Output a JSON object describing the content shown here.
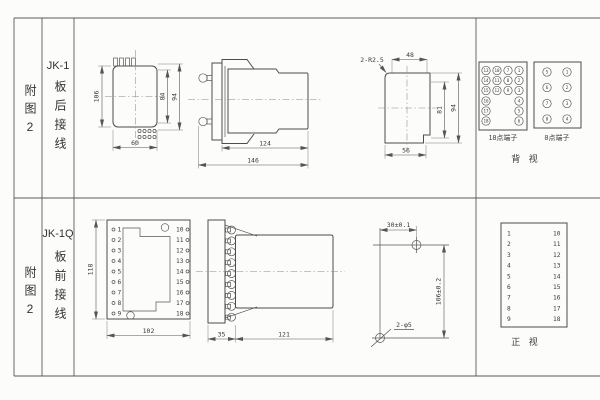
{
  "row1": {
    "figure_label": "附图2",
    "model": "JK-1",
    "wiring": "板后接线",
    "rear_view": {
      "dim_height": "106",
      "dim_inner": "84",
      "dim_outer": "94",
      "dim_width": "60"
    },
    "side_view": {
      "dim_body": "124",
      "dim_total": "146"
    },
    "cutout": {
      "callout": "2-R2.5",
      "dim_top": "48",
      "dim_inner": "81",
      "dim_outer": "94",
      "dim_bottom": "56"
    },
    "terminal18": {
      "label": "18点端子",
      "rows": [
        [
          "13",
          "10",
          "7",
          "1"
        ],
        [
          "14",
          "11",
          "8",
          "2"
        ],
        [
          "15",
          "12",
          "9",
          "3"
        ],
        [
          "16",
          "4"
        ],
        [
          "17",
          "5"
        ],
        [
          "18",
          "6"
        ]
      ]
    },
    "terminal8": {
      "label": "8点端子",
      "left": [
        "5",
        "6",
        "7",
        "8"
      ],
      "right": [
        "1",
        "2",
        "3",
        "4"
      ]
    },
    "view_label": "背 视"
  },
  "row2": {
    "figure_label": "附图2",
    "model": "JK-1Q",
    "wiring": "板前接线",
    "front_view": {
      "dim_height": "118",
      "dim_width": "102"
    },
    "terminal_numbers": {
      "left": [
        "1",
        "2",
        "3",
        "4",
        "5",
        "6",
        "7",
        "8",
        "9"
      ],
      "right": [
        "10",
        "11",
        "12",
        "13",
        "14",
        "15",
        "16",
        "17",
        "18"
      ]
    },
    "side_view": {
      "dim_front": "35",
      "dim_body": "121"
    },
    "drill": {
      "dim_h": "30±0.1",
      "dim_v": "106±0.2",
      "holes": "2-φ5"
    },
    "view_label": "正 视"
  }
}
